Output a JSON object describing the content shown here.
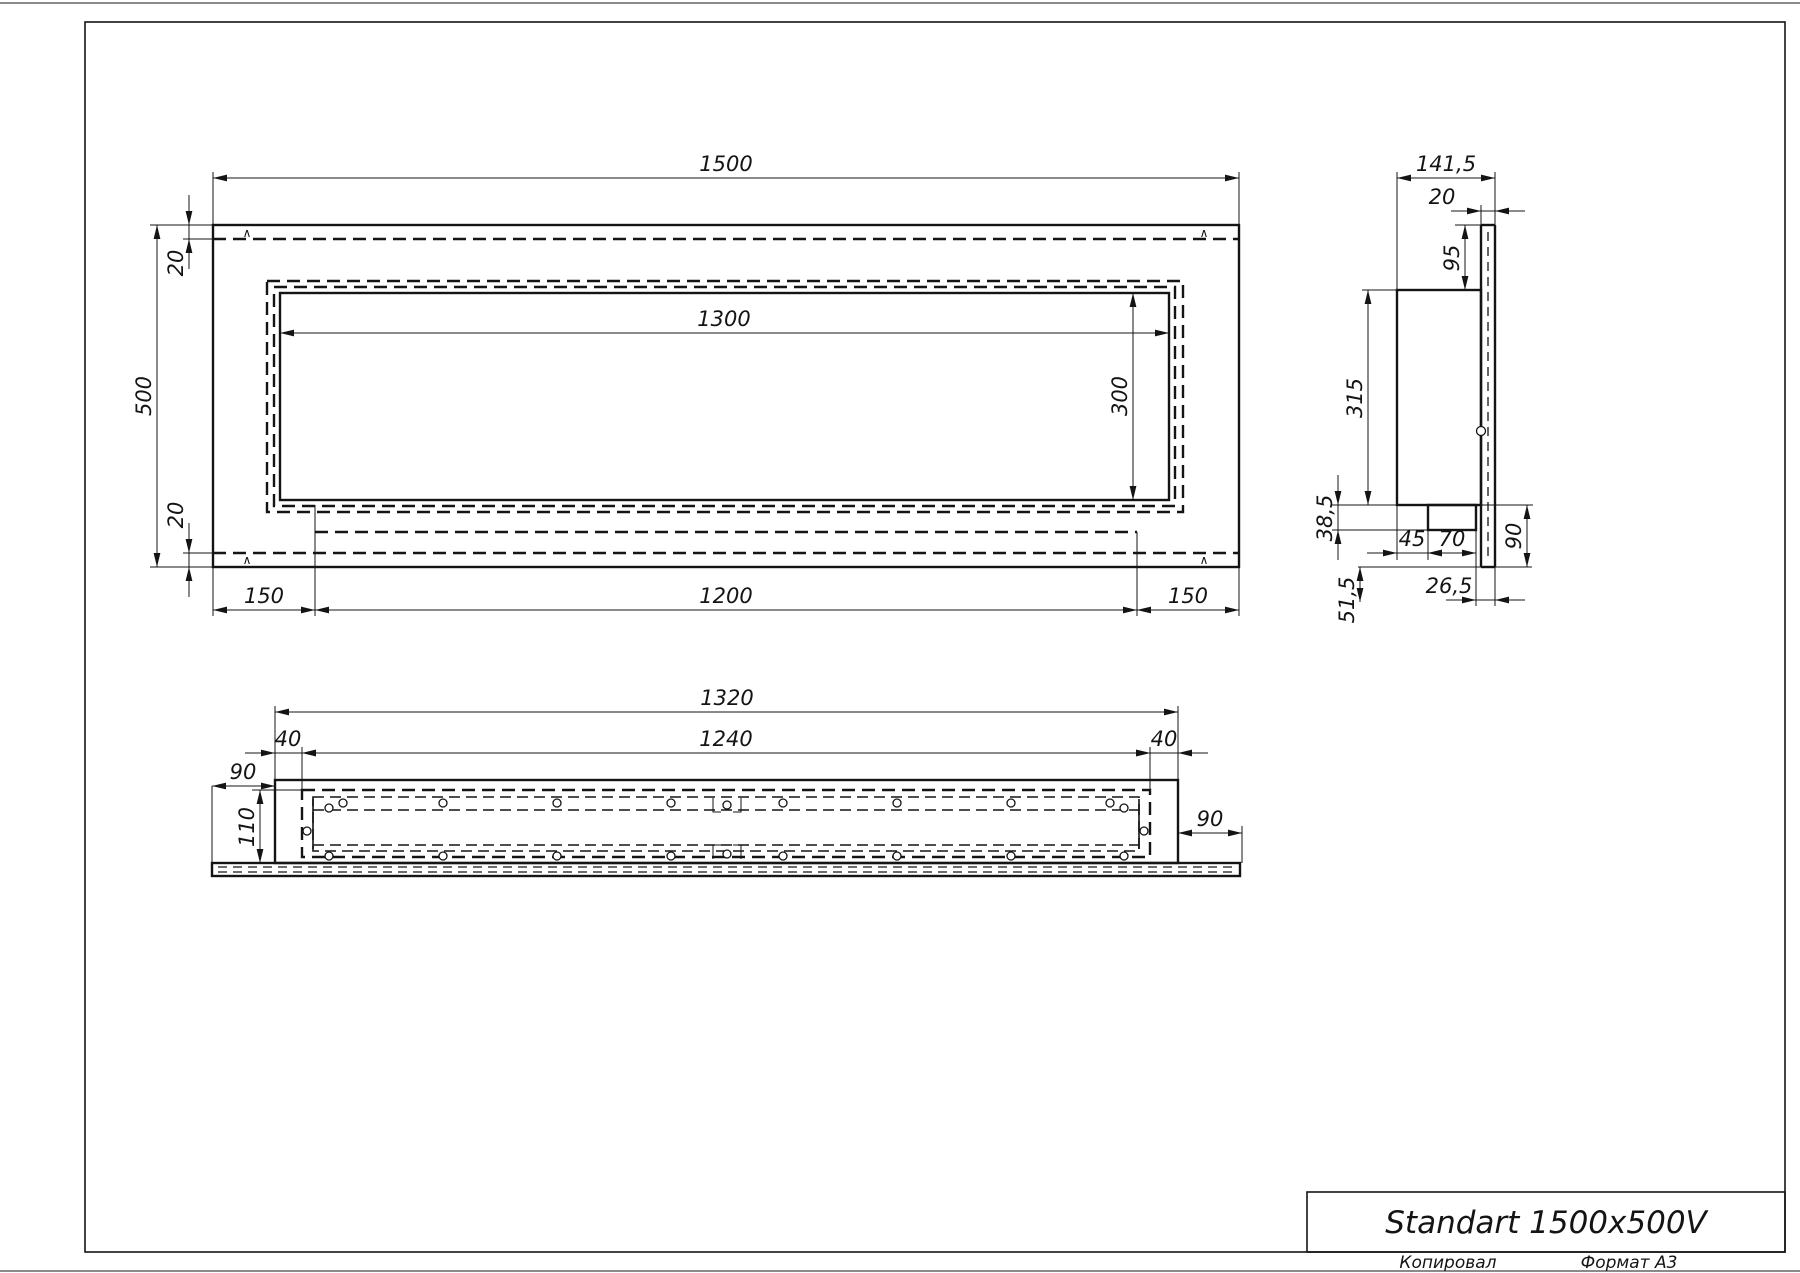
{
  "drawing": {
    "front_view": {
      "dims": {
        "width": "1500",
        "height": "500",
        "top_gap": "20",
        "bottom_gap": "20",
        "opening_width": "1300",
        "opening_height": "300",
        "bottom_left": "150",
        "bottom_center": "1200",
        "bottom_right": "150"
      },
      "section_mark": "∧"
    },
    "side_view": {
      "dims": {
        "depth_total": "141,5",
        "front_gap": "20",
        "top_flange": "95",
        "body_height": "315",
        "tray_drop": "38,5",
        "tray_offset": "45",
        "tray_width": "70",
        "bottom_flange": "90",
        "tray_to_edge": "26,5",
        "below_edge": "51,5"
      }
    },
    "bottom_view": {
      "dims": {
        "body_width": "1320",
        "opening_width": "1240",
        "side_gap_left": "40",
        "side_gap_right": "40",
        "flange_left": "90",
        "depth": "110",
        "flange_right": "90"
      }
    }
  },
  "title_block": {
    "title": "Standart 1500x500V",
    "copied": "Копировал",
    "format": "Формат А3"
  }
}
